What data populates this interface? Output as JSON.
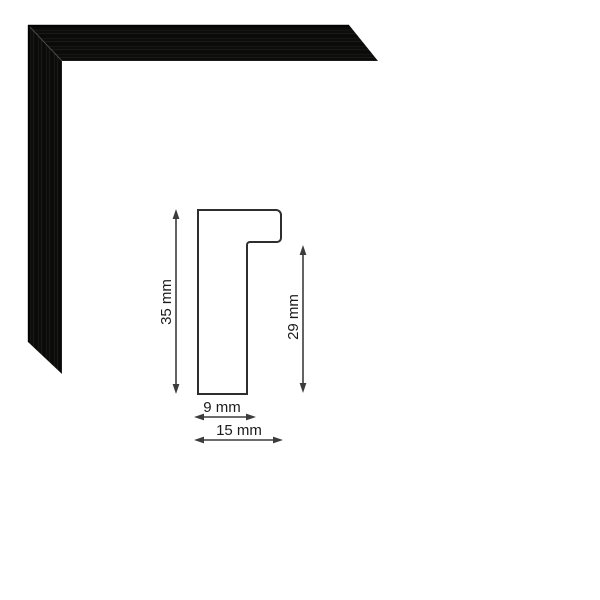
{
  "page": {
    "background_color": "#ffffff"
  },
  "frame_sample": {
    "fill_color": "#0d0d0c",
    "edge_shadow_color": "#000000",
    "miter_seam_color": "rgba(255,255,255,0.16)",
    "inner_edge_highlight_color": "rgba(255,255,255,0.14)"
  },
  "diagram": {
    "profile_fill_color": "#ffffff",
    "outline_color": "#2e2e2e",
    "arrow_color": "#3c3c3c",
    "text_color": "#1b1b1b",
    "dimensions": {
      "height": {
        "label": "35 mm",
        "value": 35,
        "unit": "mm"
      },
      "rebate": {
        "label": "29 mm",
        "value": 29,
        "unit": "mm"
      },
      "face_width": {
        "label": "9 mm",
        "value": 9,
        "unit": "mm"
      },
      "total_width": {
        "label": "15 mm",
        "value": 15,
        "unit": "mm"
      }
    }
  }
}
